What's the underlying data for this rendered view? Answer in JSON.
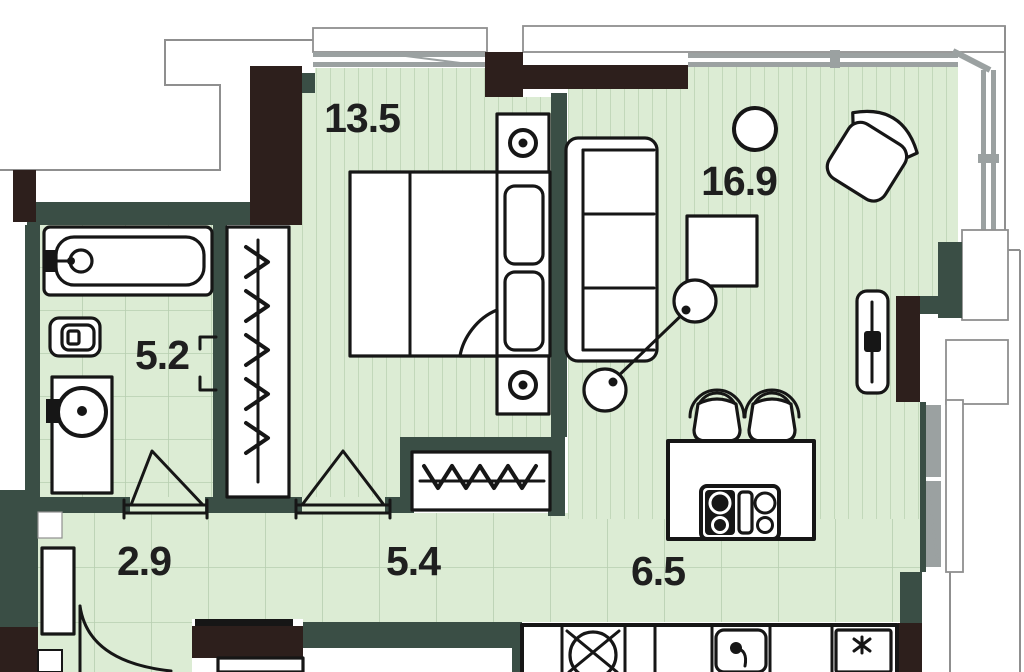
{
  "rooms": {
    "bedroom": {
      "area": "13.5"
    },
    "living_room": {
      "area": "16.9"
    },
    "bathroom": {
      "area": "5.2"
    },
    "hallway": {
      "area": "2.9"
    },
    "corridor": {
      "area": "5.4"
    },
    "kitchen": {
      "area": "6.5"
    }
  },
  "colors": {
    "floor": "#dcecd4",
    "floor_line": "#c2d8ba",
    "grid_line": "#b7ceb0",
    "wall_teal": "#3a4e45",
    "wall_dark": "#2d1f1c",
    "ink": "#161616",
    "label": "#1f1f1f",
    "outline_gray": "#8f8f8f",
    "window_gray": "#9ba1a1"
  },
  "furniture_icons": [
    "bathtub-icon",
    "toilet-icon",
    "washbasin-icon",
    "washer-icon",
    "wardrobe-hangers-icon",
    "double-bed-icon",
    "nightstand-lamp-icon",
    "sofa-icon",
    "armchair-icon",
    "coffee-table-icon",
    "floor-lamp-icon",
    "plant-icon",
    "tv-panel-icon",
    "kitchen-island-icon",
    "cooktop-icon",
    "bar-chair-icon",
    "kitchen-sink-icon",
    "faucet-icon",
    "hood-icon",
    "entry-door-arc-icon",
    "door-swing-icon",
    "console-icon"
  ]
}
